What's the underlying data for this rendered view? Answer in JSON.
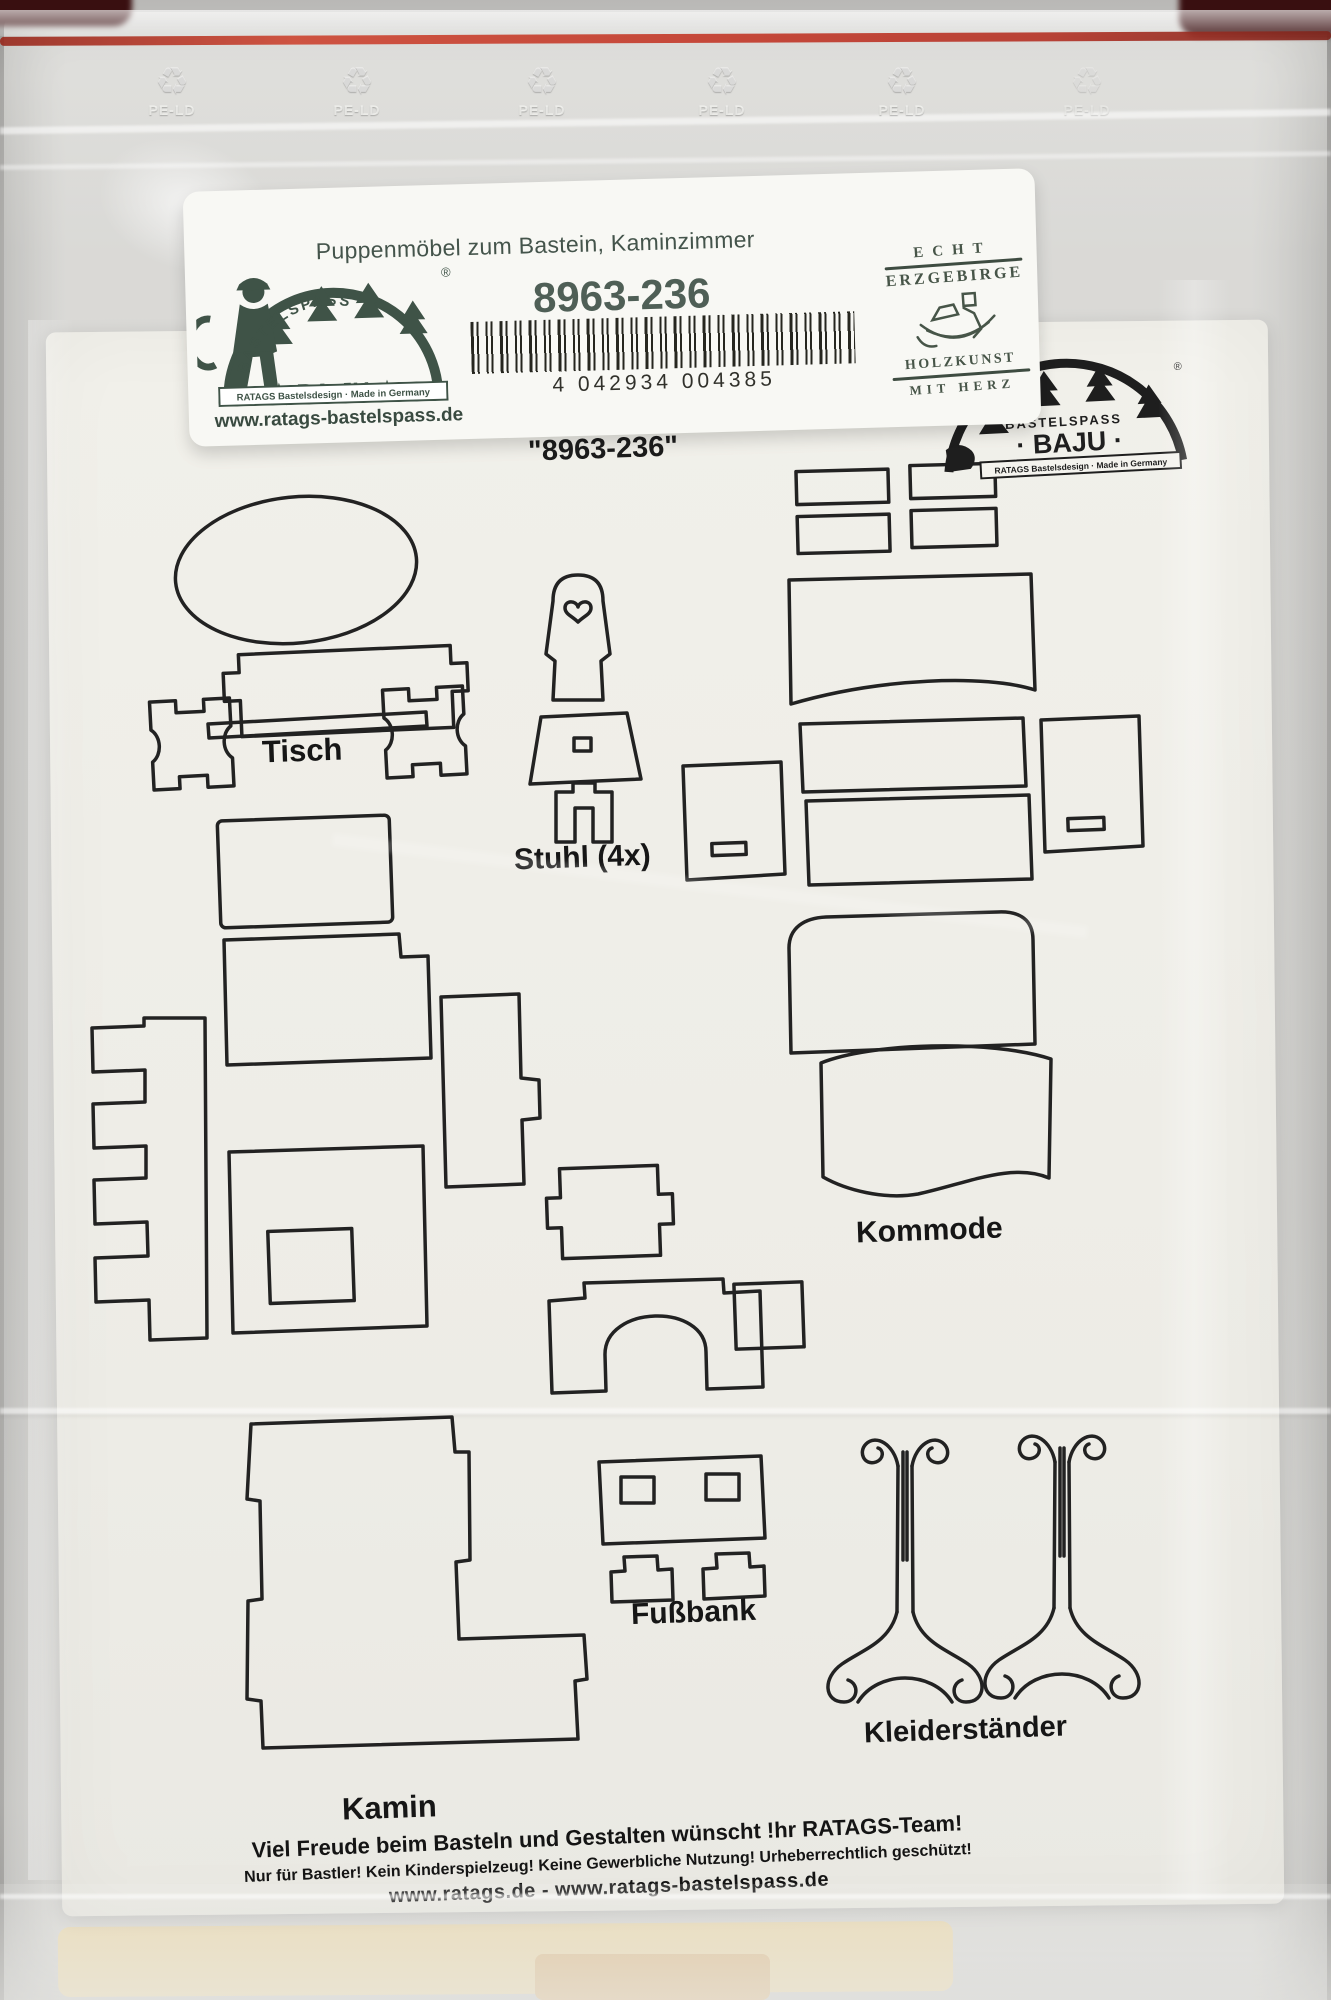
{
  "bag": {
    "material_text": "PE-LD",
    "zipper_color": "#c23727"
  },
  "label": {
    "title": "Puppenmöbel zum Bastein, Kaminzimmer",
    "product_number": "8963-236",
    "barcode_number": "4 042934 004385",
    "brand": {
      "arc_text": "BASTELSPASS",
      "name": "★ BA·JU ★",
      "registered_mark": "®",
      "bar_text": "RATAGS Bastelsdesign · Made in Germany",
      "website": "www.ratags-bastelspass.de"
    },
    "stamp": {
      "line1": "ECHT",
      "line2": "ERZGEBIRGE",
      "line3": "HOLZKUNST",
      "line4": "MIT HERZ"
    }
  },
  "sheet": {
    "heading": "Bastelset - Kaminzimmer",
    "heading_number": "\"8963-236\"",
    "print_logo": {
      "arc_text": "BASTELSPASS",
      "name": "· BAJU ·",
      "bar_text": "RATAGS Bastelsdesign · Made in Germany"
    },
    "parts": {
      "tisch": "Tisch",
      "stuhl": "Stuhl (4x)",
      "kommode": "Kommode",
      "kamin": "Kamin",
      "fussbank": "Fußbank",
      "kleiderstaender": "Kleiderständer"
    },
    "footer": {
      "line1": "Viel Freude beim Basteln und Gestalten wünscht !hr RATAGS-Team!",
      "line2": "Nur für Bastler! Kein Kinderspielzeug! Keine Gewerbliche Nutzung! Urheberrechtlich geschützt!",
      "line3": "www.ratags.de - www.ratags-bastelspass.de"
    }
  },
  "colors": {
    "brand_green": "#3f5347",
    "print_black": "#1e1e1e",
    "zipper_red": "#c23727"
  }
}
